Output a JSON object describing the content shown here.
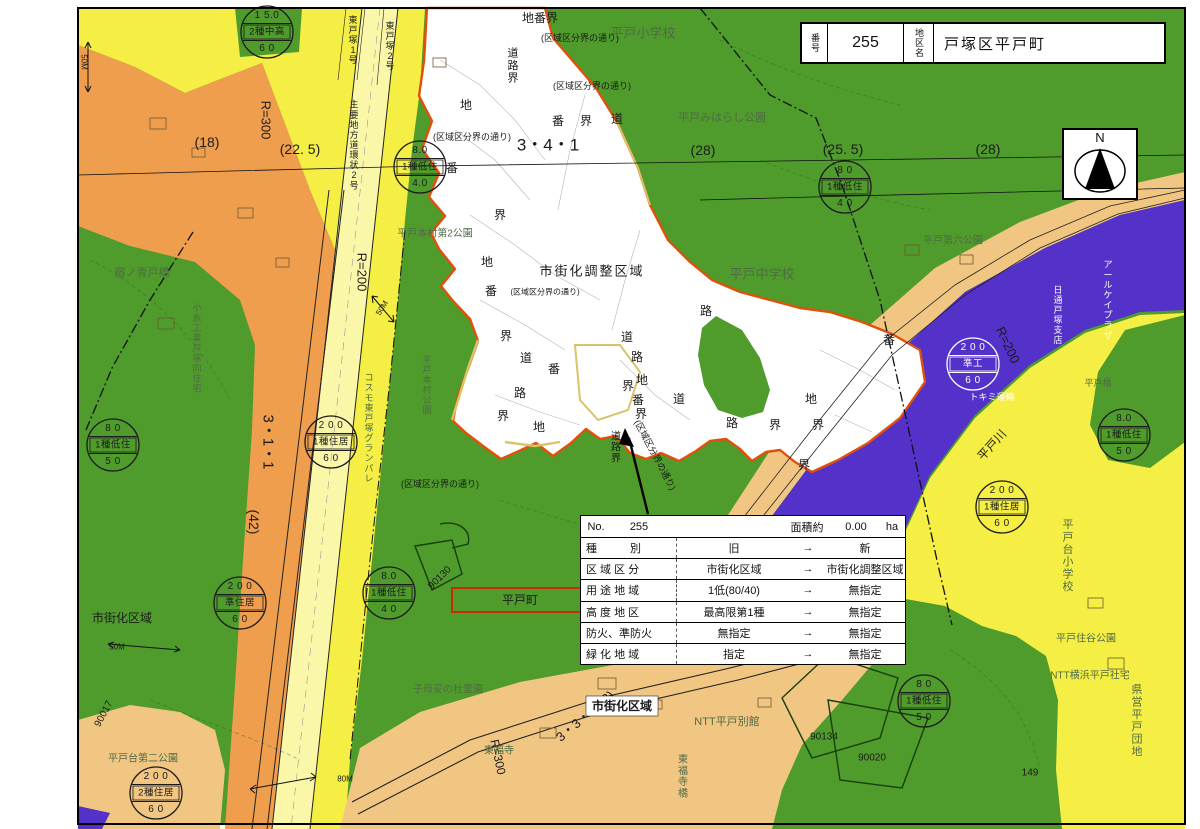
{
  "colors": {
    "ink": "#1b1b1b",
    "facility_text": "#4f6b45",
    "residential_yellow": "#f5ee44",
    "commercial_orange": "#ef9e4e",
    "adjustment_green": "#4f9c2c",
    "semi_industrial_purple": "#5431c9",
    "residential_tan": "#f1c683",
    "road_pale": "#fbf7a8",
    "subject_boundary": "#e0500a",
    "secondary_boundary": "#d8c468",
    "highlight_red": "#cc2a00"
  },
  "title_box": {
    "no_label": "番号",
    "no_value": "255",
    "name_label": "地区名",
    "name_value": "戸塚区平戸町"
  },
  "compass": {
    "label": "N"
  },
  "info_table": {
    "no_label": "No.",
    "no_value": "255",
    "area_label": "面積約",
    "area_value": "0.00",
    "area_unit": "ha",
    "arrow": "→",
    "rows": [
      {
        "category": "種　　　別",
        "old": "旧",
        "new": "新"
      },
      {
        "category": "区 域 区 分",
        "old": "市街化区域",
        "new": "市街化調整区域"
      },
      {
        "category": "用 途 地 域",
        "old": "1低(80/40)",
        "new": "無指定"
      },
      {
        "category": "高 度 地 区",
        "old": "最高限第1種",
        "new": "無指定"
      },
      {
        "category": "防火、準防火",
        "old": "無指定",
        "new": "無指定"
      },
      {
        "category": "緑 化 地 域",
        "old": "指定",
        "new": "無指定"
      }
    ]
  },
  "zone_circles": [
    {
      "x": 267,
      "y": 32,
      "top": "1 5.0",
      "mid": "2種中高",
      "bot": "6 0"
    },
    {
      "x": 420,
      "y": 167,
      "top": "8.0",
      "mid": "1種低住",
      "bot": "4.0"
    },
    {
      "x": 845,
      "y": 187,
      "top": "8 0",
      "mid": "1種低住",
      "bot": "4 0"
    },
    {
      "x": 113,
      "y": 445,
      "top": "8 0",
      "mid": "1種低住",
      "bot": "5 0"
    },
    {
      "x": 331,
      "y": 442,
      "top": "2 0 0",
      "mid": "1種住居",
      "bot": "6 0"
    },
    {
      "x": 973,
      "y": 364,
      "top": "2 0 0",
      "mid": "準工",
      "bot": "6 0",
      "white": true
    },
    {
      "x": 1124,
      "y": 435,
      "top": "8.0",
      "mid": "1種低住",
      "bot": "5 0"
    },
    {
      "x": 1002,
      "y": 507,
      "top": "2 0 0",
      "mid": "1種住居",
      "bot": "6 0"
    },
    {
      "x": 389,
      "y": 593,
      "top": "8.0",
      "mid": "1種低住",
      "bot": "4 0"
    },
    {
      "x": 240,
      "y": 603,
      "top": "2 0 0",
      "mid": "準住居",
      "bot": "6 0"
    },
    {
      "x": 156,
      "y": 793,
      "top": "2 0 0",
      "mid": "2種住居",
      "bot": "6 0"
    },
    {
      "x": 924,
      "y": 701,
      "top": "8 0",
      "mid": "1種低住",
      "bot": "5 0"
    }
  ],
  "map_labels": [
    {
      "name": "label-chibankai",
      "text": "地番界",
      "x": 540,
      "y": 18,
      "s": 12
    },
    {
      "name": "label-dorokai",
      "text": "道路界",
      "x": 513,
      "y": 66,
      "s": 11,
      "v": 1
    },
    {
      "name": "label-kuiki-line",
      "text": "(区域区分界の通り)",
      "x": 580,
      "y": 38,
      "s": 9
    },
    {
      "name": "label-kuiki-line",
      "text": "(区域区分界の通り)",
      "x": 592,
      "y": 86,
      "s": 9
    },
    {
      "name": "label-kuiki-line",
      "text": "(区域区分界の通り)",
      "x": 472,
      "y": 137,
      "s": 9
    },
    {
      "name": "label-kuiki-line",
      "text": "(区域区分界の通り)",
      "x": 545,
      "y": 292,
      "s": 8
    },
    {
      "name": "label-kuiki-line",
      "text": "(区域区分界の通り)",
      "x": 440,
      "y": 484,
      "s": 9
    },
    {
      "name": "label-kuiki-line",
      "text": "(区域区分界の通り)",
      "x": 655,
      "y": 455,
      "s": 9,
      "rot": 62
    },
    {
      "name": "label-school",
      "text": "平戸小学校",
      "x": 643,
      "y": 33,
      "s": 13,
      "c": "park"
    },
    {
      "name": "label-park",
      "text": "平戸みはらし公園",
      "x": 722,
      "y": 118,
      "s": 11,
      "c": "park"
    },
    {
      "name": "label-school",
      "text": "平戸中学校",
      "x": 762,
      "y": 274,
      "s": 13,
      "c": "park"
    },
    {
      "name": "label-park",
      "text": "平戸第六公園",
      "x": 953,
      "y": 241,
      "s": 10,
      "c": "park"
    },
    {
      "name": "label-road-name",
      "text": "3・4・1",
      "x": 548,
      "y": 145,
      "s": 17
    },
    {
      "name": "label-road-width",
      "text": "(28)",
      "x": 703,
      "y": 150,
      "s": 14
    },
    {
      "name": "label-road-width",
      "text": "(25. 5)",
      "x": 843,
      "y": 149,
      "s": 14
    },
    {
      "name": "label-road-width",
      "text": "(28)",
      "x": 988,
      "y": 149,
      "s": 14
    },
    {
      "name": "label-road-width",
      "text": "(18)",
      "x": 207,
      "y": 142,
      "s": 14
    },
    {
      "name": "label-road-width",
      "text": "(22. 5)",
      "x": 300,
      "y": 149,
      "s": 14
    },
    {
      "name": "label-radius",
      "text": "R=300",
      "x": 266,
      "y": 120,
      "s": 13,
      "rot": 90
    },
    {
      "name": "label-radius",
      "text": "R=200",
      "x": 362,
      "y": 272,
      "s": 13,
      "rot": 90
    },
    {
      "name": "label-radius",
      "text": "R=200",
      "x": 1008,
      "y": 345,
      "s": 13,
      "rot": 65
    },
    {
      "name": "label-radius",
      "text": "R=300",
      "x": 498,
      "y": 757,
      "s": 12,
      "rot": 78
    },
    {
      "name": "label-road-name",
      "text": "3・3・2(22)",
      "x": 585,
      "y": 716,
      "s": 13,
      "rot": -40
    },
    {
      "name": "label-road-name",
      "text": "3・1・1",
      "x": 268,
      "y": 442,
      "s": 15,
      "rot": 90
    },
    {
      "name": "label-road-width",
      "text": "(42)",
      "x": 254,
      "y": 522,
      "s": 14,
      "rot": 90
    },
    {
      "name": "label-zone",
      "text": "市街化調整区域",
      "x": 592,
      "y": 271,
      "s": 13,
      "ls": 2
    },
    {
      "name": "label-zone",
      "text": "市街化区域",
      "x": 122,
      "y": 618,
      "s": 12
    },
    {
      "name": "label-zone-boxed",
      "text": "市街化区域",
      "x": 622,
      "y": 706,
      "s": 12,
      "b": 1,
      "bg": "#ffffff"
    },
    {
      "name": "label-subject-town",
      "text": "平戸町",
      "x": 520,
      "y": 600,
      "s": 12,
      "frame": 1,
      "fw": 136,
      "fh": 24
    },
    {
      "name": "label-road-name",
      "text": "東戸塚1号",
      "x": 353,
      "y": 40,
      "s": 9,
      "v": 1
    },
    {
      "name": "label-road-name",
      "text": "東戸塚2号",
      "x": 390,
      "y": 46,
      "s": 9,
      "v": 1
    },
    {
      "name": "label-road-name",
      "text": "主要地方道環状2号",
      "x": 354,
      "y": 145,
      "s": 9,
      "v": 1
    },
    {
      "name": "label-bridge",
      "text": "宿ノ青戸橋",
      "x": 142,
      "y": 273,
      "s": 11,
      "c": "park"
    },
    {
      "name": "label-housing",
      "text": "小糸工業戸塚向住宅",
      "x": 197,
      "y": 348,
      "s": 9,
      "v": 1,
      "c": "park"
    },
    {
      "name": "label-housing",
      "text": "コスモ東戸塚グランパレ",
      "x": 369,
      "y": 428,
      "s": 9,
      "v": 1,
      "c": "park"
    },
    {
      "name": "label-park",
      "text": "平戸本村公園",
      "x": 427,
      "y": 385,
      "s": 9,
      "v": 1,
      "c": "park"
    },
    {
      "name": "label-park",
      "text": "平戸本村第2公園",
      "x": 435,
      "y": 234,
      "s": 10,
      "c": "park"
    },
    {
      "name": "label-school",
      "text": "平戸台小学校",
      "x": 1068,
      "y": 556,
      "s": 11,
      "v": 1,
      "c": "park"
    },
    {
      "name": "label-park",
      "text": "平戸台第二公園",
      "x": 143,
      "y": 759,
      "s": 10,
      "c": "park"
    },
    {
      "name": "label-facility",
      "text": "NTT平戸別館",
      "x": 727,
      "y": 722,
      "s": 11,
      "c": "park"
    },
    {
      "name": "label-temple",
      "text": "東福寺",
      "x": 499,
      "y": 751,
      "s": 10,
      "c": "park"
    },
    {
      "name": "label-bridge",
      "text": "東福寺橋",
      "x": 683,
      "y": 777,
      "s": 10,
      "v": 1,
      "c": "park"
    },
    {
      "name": "label-cemetery",
      "text": "子母妥の杜霊園",
      "x": 448,
      "y": 690,
      "s": 10,
      "c": "park"
    },
    {
      "name": "label-facility",
      "text": "NTT横浜平戸社宅",
      "x": 1090,
      "y": 676,
      "s": 10,
      "c": "park"
    },
    {
      "name": "label-housing",
      "text": "県営平戸団地",
      "x": 1137,
      "y": 721,
      "s": 11,
      "v": 1,
      "c": "park"
    },
    {
      "name": "label-park",
      "text": "平戸住谷公園",
      "x": 1086,
      "y": 639,
      "s": 10,
      "c": "park"
    },
    {
      "name": "label-river",
      "text": "平戸川",
      "x": 992,
      "y": 445,
      "s": 12,
      "rot": -48
    },
    {
      "name": "label-bridge",
      "text": "平戸橋",
      "x": 1098,
      "y": 383,
      "s": 9,
      "c": "park"
    },
    {
      "name": "label-facility",
      "text": "日通戸塚支店",
      "x": 1058,
      "y": 315,
      "s": 9,
      "v": 1,
      "c": "white"
    },
    {
      "name": "label-facility",
      "text": "アールケイプラザ",
      "x": 1108,
      "y": 300,
      "s": 9,
      "v": 1,
      "c": "white"
    },
    {
      "name": "label-facility",
      "text": "トキミ運輸",
      "x": 992,
      "y": 397,
      "s": 9,
      "c": "white"
    },
    {
      "name": "label-parcel-number",
      "text": "90017",
      "x": 104,
      "y": 714,
      "s": 10,
      "rot": -62
    },
    {
      "name": "label-parcel-number",
      "text": "90130",
      "x": 440,
      "y": 578,
      "s": 10,
      "rot": -45
    },
    {
      "name": "label-parcel-number",
      "text": "90134",
      "x": 824,
      "y": 737,
      "s": 10
    },
    {
      "name": "label-parcel-number",
      "text": "90020",
      "x": 872,
      "y": 758,
      "s": 10
    },
    {
      "name": "label-parcel-number",
      "text": "149",
      "x": 1030,
      "y": 773,
      "s": 10
    },
    {
      "name": "label-measure",
      "text": "50M",
      "x": 84,
      "y": 62,
      "s": 8,
      "rot": 90
    },
    {
      "name": "label-measure",
      "text": "50M",
      "x": 382,
      "y": 308,
      "s": 8,
      "rot": -58
    },
    {
      "name": "label-measure",
      "text": "50M",
      "x": 117,
      "y": 647,
      "s": 8
    },
    {
      "name": "label-measure",
      "text": "80M",
      "x": 345,
      "y": 779,
      "s": 8
    },
    {
      "name": "boundary-kanji",
      "text": "地",
      "x": 466,
      "y": 105,
      "s": 12
    },
    {
      "name": "boundary-kanji",
      "text": "番",
      "x": 452,
      "y": 168,
      "s": 12
    },
    {
      "name": "boundary-kanji",
      "text": "番",
      "x": 558,
      "y": 121,
      "s": 12
    },
    {
      "name": "boundary-kanji",
      "text": "界",
      "x": 586,
      "y": 121,
      "s": 12
    },
    {
      "name": "boundary-kanji",
      "text": "道",
      "x": 617,
      "y": 119,
      "s": 12
    },
    {
      "name": "boundary-kanji",
      "text": "界",
      "x": 500,
      "y": 215,
      "s": 12
    },
    {
      "name": "boundary-kanji",
      "text": "地",
      "x": 487,
      "y": 262,
      "s": 12
    },
    {
      "name": "boundary-kanji",
      "text": "番",
      "x": 491,
      "y": 291,
      "s": 12
    },
    {
      "name": "boundary-kanji",
      "text": "界",
      "x": 506,
      "y": 336,
      "s": 12
    },
    {
      "name": "boundary-kanji",
      "text": "道",
      "x": 526,
      "y": 358,
      "s": 12
    },
    {
      "name": "boundary-kanji",
      "text": "番",
      "x": 554,
      "y": 369,
      "s": 12
    },
    {
      "name": "boundary-kanji",
      "text": "路",
      "x": 520,
      "y": 393,
      "s": 12
    },
    {
      "name": "boundary-kanji",
      "text": "界",
      "x": 503,
      "y": 416,
      "s": 12
    },
    {
      "name": "boundary-kanji",
      "text": "地",
      "x": 539,
      "y": 427,
      "s": 12
    },
    {
      "name": "boundary-kanji",
      "text": "道",
      "x": 627,
      "y": 337,
      "s": 12
    },
    {
      "name": "boundary-kanji",
      "text": "路",
      "x": 637,
      "y": 357,
      "s": 12
    },
    {
      "name": "boundary-kanji",
      "text": "地",
      "x": 642,
      "y": 380,
      "s": 12
    },
    {
      "name": "boundary-kanji",
      "text": "界",
      "x": 628,
      "y": 386,
      "s": 12
    },
    {
      "name": "boundary-kanji",
      "text": "番",
      "x": 638,
      "y": 400,
      "s": 12
    },
    {
      "name": "boundary-kanji",
      "text": "界",
      "x": 641,
      "y": 414,
      "s": 12
    },
    {
      "name": "boundary-kanji",
      "text": "道",
      "x": 679,
      "y": 399,
      "s": 12
    },
    {
      "name": "boundary-kanji",
      "text": "路",
      "x": 706,
      "y": 311,
      "s": 12
    },
    {
      "name": "boundary-kanji",
      "text": "路",
      "x": 732,
      "y": 423,
      "s": 12
    },
    {
      "name": "boundary-kanji",
      "text": "界",
      "x": 775,
      "y": 425,
      "s": 12
    },
    {
      "name": "boundary-kanji",
      "text": "地",
      "x": 811,
      "y": 399,
      "s": 12
    },
    {
      "name": "boundary-kanji",
      "text": "界",
      "x": 818,
      "y": 425,
      "s": 12
    },
    {
      "name": "boundary-kanji",
      "text": "番",
      "x": 889,
      "y": 340,
      "s": 12
    },
    {
      "name": "boundary-kanji",
      "text": "界",
      "x": 804,
      "y": 465,
      "s": 12
    },
    {
      "name": "label-dorokai",
      "text": "道路界",
      "x": 616,
      "y": 448,
      "s": 10,
      "v": 1
    }
  ]
}
